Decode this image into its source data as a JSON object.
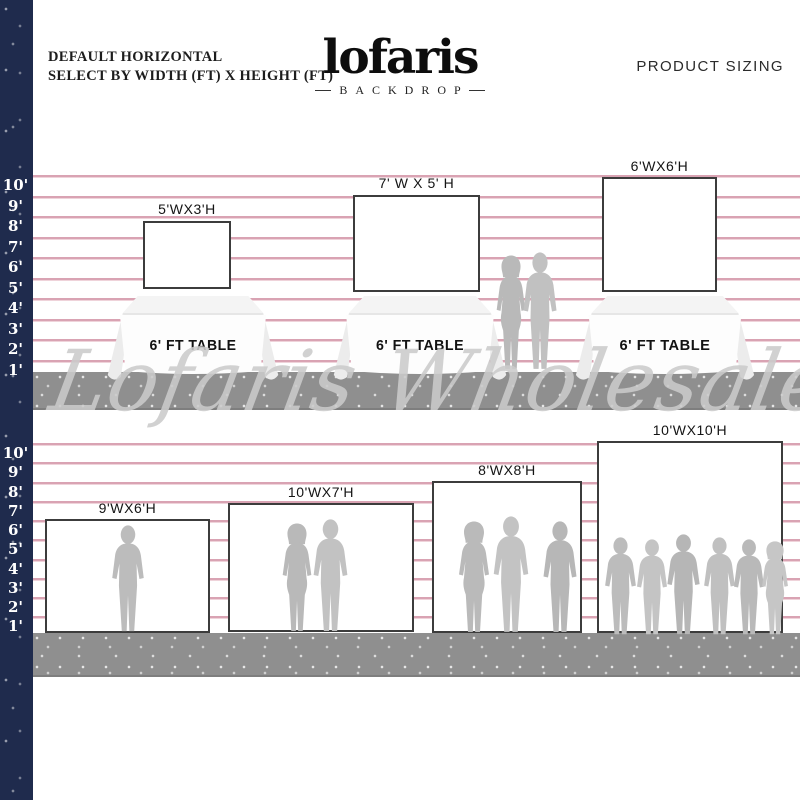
{
  "header": {
    "tagline_line1": "DEFAULT HORIZONTAL",
    "tagline_line2": "SELECT BY WIDTH (FT) X HEIGHT (FT)",
    "brand": {
      "name": "lofaris",
      "sub": "BACKDROP"
    },
    "product_sizing": "PRODUCT SIZING"
  },
  "rulers": {
    "top": [
      "10'",
      "9'",
      "8'",
      "7'",
      "6'",
      "5'",
      "4'",
      "3'",
      "2'",
      "1'"
    ],
    "bottom": [
      "10'",
      "9'",
      "8'",
      "7'",
      "6'",
      "5'",
      "4'",
      "3'",
      "2'",
      "1'"
    ]
  },
  "table_row": {
    "backdrops": [
      {
        "label": "5'WX3'H",
        "width_ft": 5,
        "height_ft": 3
      },
      {
        "label": "7' W X 5' H",
        "width_ft": 7,
        "height_ft": 5
      },
      {
        "label": "6'WX6'H",
        "width_ft": 6,
        "height_ft": 6
      }
    ],
    "tables": [
      {
        "label": "6' FT TABLE"
      },
      {
        "label": "6' FT TABLE"
      },
      {
        "label": "6' FT TABLE"
      }
    ]
  },
  "floor_row": {
    "backdrops": [
      {
        "label": "9'WX6'H",
        "width_ft": 9,
        "height_ft": 6,
        "people_count": 1
      },
      {
        "label": "10'WX7'H",
        "width_ft": 10,
        "height_ft": 7,
        "people_count": 2
      },
      {
        "label": "8'WX8'H",
        "width_ft": 8,
        "height_ft": 8,
        "people_count": 3
      },
      {
        "label": "10'WX10'H",
        "width_ft": 10,
        "height_ft": 10,
        "people_count": 6
      }
    ]
  },
  "watermark": "Lofaris Wholesale",
  "colors": {
    "navy_bar": "#1f2b4d",
    "line_pink": "#d9a3b3",
    "floor_gray": "#8f8f8f",
    "silhouette_gray": "#bcbcbc",
    "backdrop_border": "#3c3c3c"
  }
}
